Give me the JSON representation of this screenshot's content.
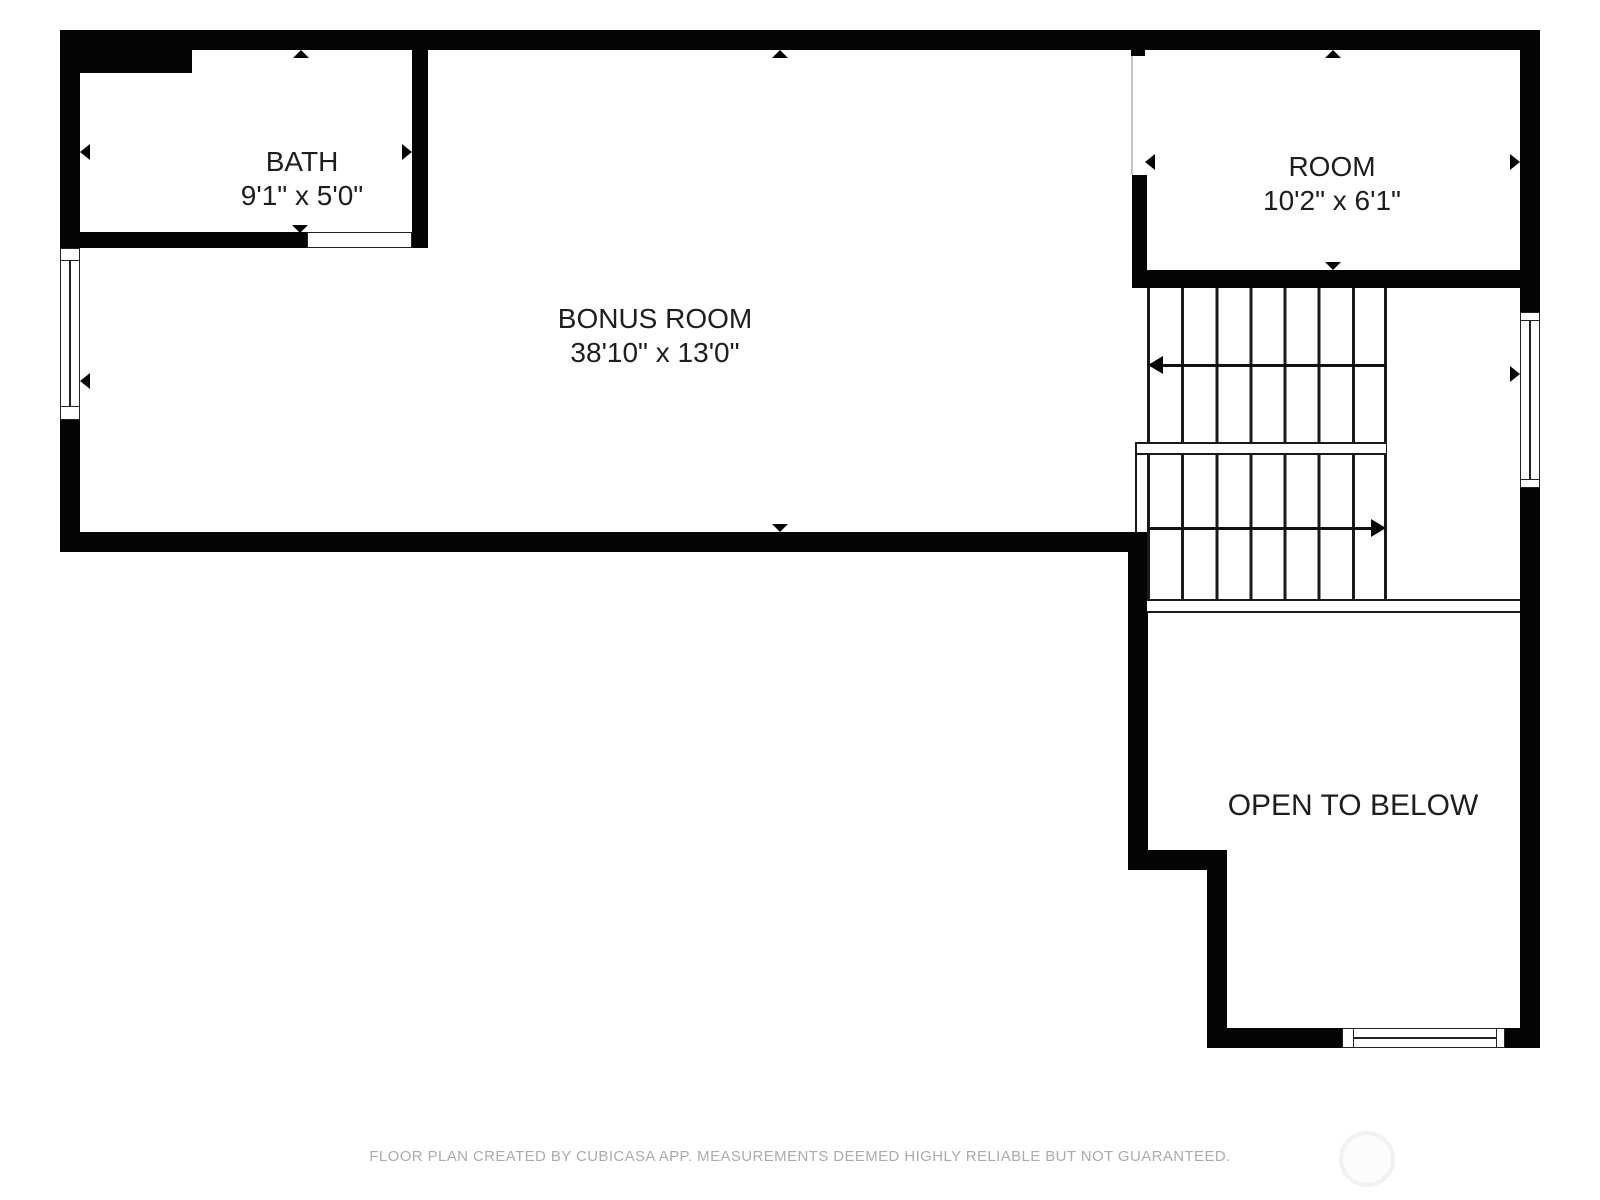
{
  "floorplan": {
    "rooms": {
      "bath": {
        "label": "BATH",
        "dims": "9'1\" x 5'0\""
      },
      "room": {
        "label": "ROOM",
        "dims": "10'2\" x 6'1\""
      },
      "bonus": {
        "label": "BONUS ROOM",
        "dims": "38'10\" x 13'0\""
      },
      "open_to_below": {
        "label": "OPEN TO BELOW"
      }
    },
    "footer": "FLOOR PLAN CREATED BY CUBICASA APP. MEASUREMENTS DEEMED HIGHLY RELIABLE BUT NOT GUARANTEED.",
    "colors": {
      "wall": "#050505",
      "label_text": "#1e1e1e",
      "footer_text": "#ababab",
      "stair_line": "#1a1a1a",
      "logo_ring": "#f1f1f1"
    }
  }
}
